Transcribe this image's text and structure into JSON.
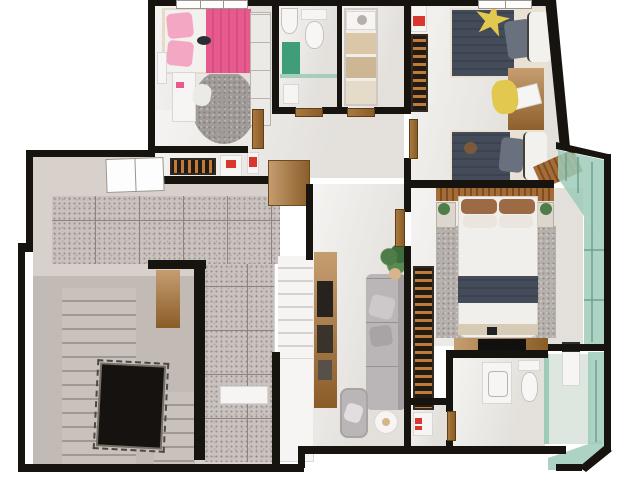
{
  "title": "3D rendered floor plan — upper storey",
  "colors": {
    "bg": "#ffffff",
    "wall": "#17130f",
    "marble": "#eceae6",
    "tileBase": "#c9c2bf",
    "tileLine": "#8d837f",
    "plaster": "#d8d1cb",
    "plasterShade": "#c2bab4",
    "concrete": "#c9c1bb",
    "concreteLine": "#a19892",
    "voidc": "#161210",
    "wood": "#c59e70",
    "woodDark": "#8a5c28",
    "pink": "#e85a8e",
    "pinkLight": "#f4a7c3",
    "green": "#3f9e78",
    "glass": "#9ecbb8",
    "sofa": "#bab5b7",
    "bedDark": "#454c59",
    "yellow": "#e2c84e",
    "red": "#d8372e",
    "tan": "#d6b48c",
    "rugGray": "#a19b99",
    "rugMaster": "#b7b1ad"
  },
  "rooms": [
    {
      "id": "stair-hall",
      "name": "Stair hall with terrazzo landing, concrete stairs and open stairwell"
    },
    {
      "id": "hallway",
      "name": "Hallway with marble floor"
    },
    {
      "id": "bedroom-pink",
      "name": "Bedroom with pink single bed"
    },
    {
      "id": "bathroom-small",
      "name": "Bathroom with toilet and shower"
    },
    {
      "id": "closet",
      "name": "Closet / storage room with shelving"
    },
    {
      "id": "bedroom-twin",
      "name": "Twin bedroom with two single beds"
    },
    {
      "id": "master-bedroom",
      "name": "Master bedroom with double bed"
    },
    {
      "id": "ensuite-bathroom",
      "name": "En-suite bathroom with glass shower"
    },
    {
      "id": "living-room",
      "name": "TV lounge with sofa and staircase"
    },
    {
      "id": "balcony",
      "name": "Glazed balcony with green glass panels"
    }
  ],
  "furniture": {
    "stair-hall": [
      "concrete staircase",
      "stairwell void with railing",
      "terrazzo tiled landing",
      "window",
      "slatted shoe rack",
      "white storage box with red accent",
      "fire extinguisher",
      "wooden cabinet",
      "wooden bench"
    ],
    "bedroom-pink": [
      "single bed with pink duvet",
      "pink pillows",
      "plush toy",
      "white desk",
      "white chair",
      "white wardrobe",
      "oval grey rug",
      "window"
    ],
    "bathroom-small": [
      "washbasin",
      "toilet",
      "green bath mat",
      "glass shower screen",
      "towel"
    ],
    "closet": [
      "shelving unit with storage boxes",
      "slatted rack",
      "white cabinet with red accent"
    ],
    "bedroom-twin": [
      "two single beds with dark duvets",
      "yellow star pillow",
      "grey and white pillows",
      "wooden desk with laptop",
      "yellow chair",
      "teddy bear",
      "window"
    ],
    "master-bedroom": [
      "double bed with white duvet and grey runner",
      "slatted wood headboard wall",
      "two nightstands with plants",
      "grey area rug",
      "slatted clothes rack",
      "TV console with flat TV"
    ],
    "ensuite-bathroom": [
      "vanity washbasin",
      "toilet",
      "green glass shower enclosure",
      "shower column / heater"
    ],
    "living-room": [
      "grey sofa with cushions",
      "grey armchair",
      "round white pouf",
      "potted plant",
      "wooden media sideboard",
      "white staircase flight"
    ],
    "balcony": [
      "green glass guardrail panels"
    ]
  }
}
